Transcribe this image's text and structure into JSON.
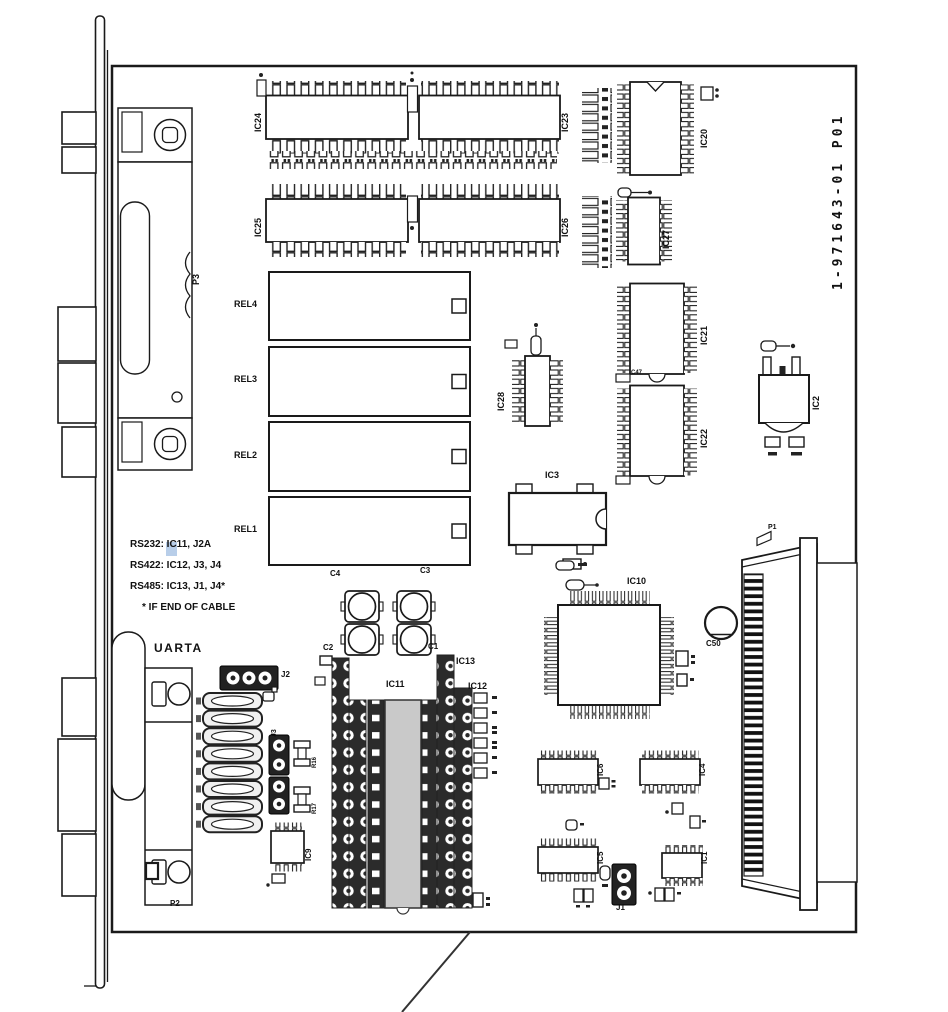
{
  "page": {
    "board_id": "1-971643-01  P01",
    "notes": {
      "rs232": "RS232: IC11, J2A",
      "rs422": "RS422: IC12, J3, J4",
      "rs485": "RS485: IC13, J1, J4*",
      "footnote": "* IF END OF CABLE"
    },
    "connectors": {
      "p1": "P1",
      "p2": "P2",
      "p3": "P3",
      "uarta": "UARTA"
    },
    "jumpers": {
      "j1": "J1",
      "j2": "J2",
      "j3": "J3"
    },
    "relays": {
      "rel1": "REL1",
      "rel2": "REL2",
      "rel3": "REL3",
      "rel4": "REL4"
    },
    "ics": {
      "ic1": "IC1",
      "ic2": "IC2",
      "ic3": "IC3",
      "ic4": "IC4",
      "ic5": "IC5",
      "ic6": "IC6",
      "ic9": "IC9",
      "ic10": "IC10",
      "ic11": "IC11",
      "ic12": "IC12",
      "ic13": "IC13",
      "ic20": "IC20",
      "ic21": "IC21",
      "ic22": "IC22",
      "ic23": "IC23",
      "ic24": "IC24",
      "ic25": "IC25",
      "ic26": "IC26",
      "ic27": "IC27",
      "ic28": "IC28"
    },
    "capacitors": {
      "c1": "C1",
      "c2": "C2",
      "c3": "C3",
      "c4": "C4",
      "c47": "C47",
      "c50": "C50"
    },
    "resistors": {
      "r16": "R16",
      "r17": "R17"
    },
    "colors": {
      "line": "#1a1a1a",
      "socket": "#2b2b2b",
      "ic_socket_body": "#c9c9c9",
      "highlight": "#7da5d7"
    }
  }
}
